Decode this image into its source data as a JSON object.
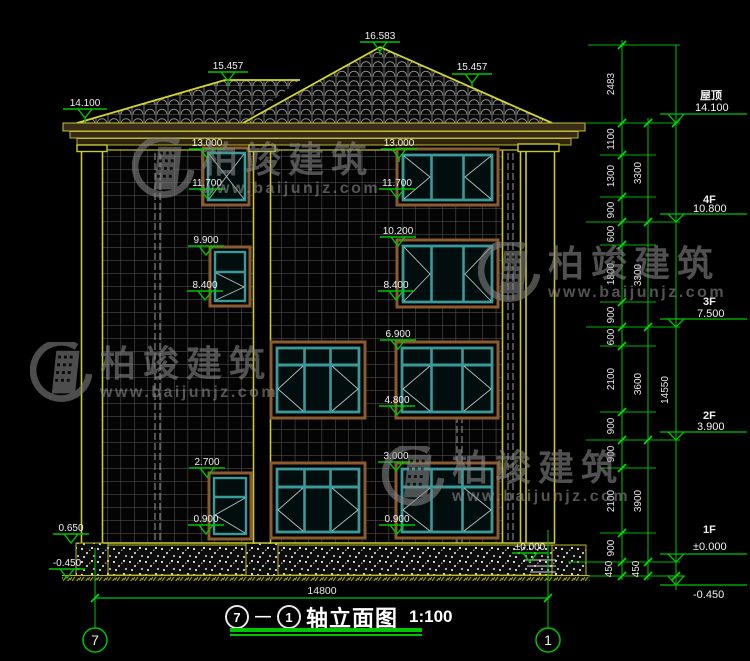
{
  "title": {
    "axis_a": "7",
    "axis_b": "1",
    "text": "轴立面图",
    "scale": "1:100"
  },
  "axes": {
    "left": "7",
    "right": "1"
  },
  "watermark": {
    "name": "柏竣建筑",
    "url": "www.baijunjz.com"
  },
  "levels": [
    {
      "label": "屋顶",
      "value": "14.100"
    },
    {
      "label": "4F",
      "value": "10.800"
    },
    {
      "label": "3F",
      "value": "7.500"
    },
    {
      "label": "2F",
      "value": "3.900"
    },
    {
      "label": "1F",
      "value": "±0.000"
    },
    {
      "label": "",
      "value": "-0.450"
    }
  ],
  "markers": [
    "16.583",
    "15.457",
    "15.457",
    "14.100",
    "13.000",
    "13.000",
    "11.700",
    "11.700",
    "9.900",
    "10.200",
    "8.400",
    "8.400",
    "6.900",
    "4.800",
    "3.000",
    "2.700",
    "0.900",
    "0.900",
    "0.650",
    "-0.450",
    "±0.000"
  ],
  "dim_chain_inner": [
    "2483",
    "1100",
    "1300",
    "900",
    "600",
    "1800",
    "900",
    "600",
    "2100",
    "900",
    "900",
    "2100",
    "900",
    "450"
  ],
  "dim_chain_floor": [
    "3300",
    "3300",
    "3600",
    "3900",
    "450"
  ],
  "dim_total": "14550",
  "dim_bottom": "14800",
  "colors": {
    "dim_green": "#00c400",
    "cad_yellow": "#d6d62a",
    "window_teal": "#3a9a9a",
    "surround_brown": "#8a5a30",
    "text_white": "#f0f0f0"
  }
}
